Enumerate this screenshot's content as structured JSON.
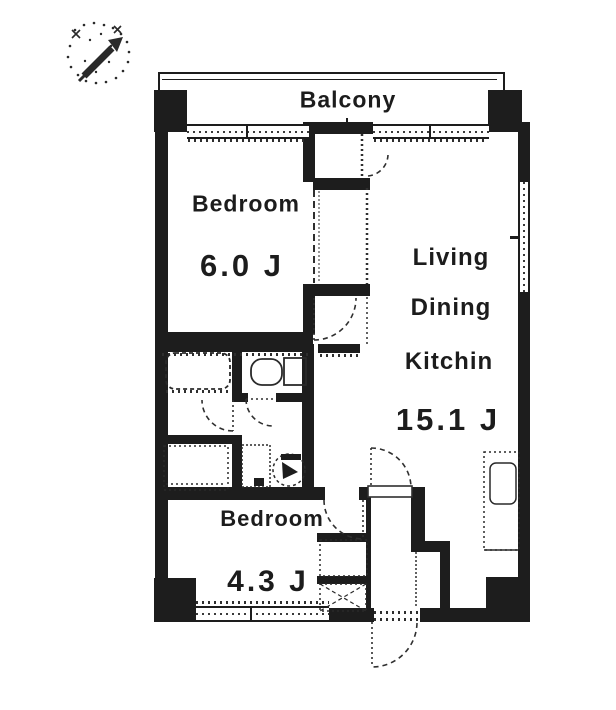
{
  "plan": {
    "balcony": {
      "label": "Balcony"
    },
    "bedroom_main": {
      "label": "Bedroom",
      "area": "6.0 J"
    },
    "living_dining_kitchen": {
      "label_line1": "Living",
      "label_line2": "Dining",
      "label_line3": "Kitchin",
      "area": "15.1 J"
    },
    "bedroom_second": {
      "label": "Bedroom",
      "area": "4.3 J"
    }
  },
  "icons": {
    "compass": "north-arrow-icon",
    "fixtures": [
      "bathtub-icon",
      "toilet-icon",
      "vanity-icon",
      "washing-machine-icon",
      "water-heater-icon",
      "kitchen-sink-icon",
      "storage-cross-icon",
      "door-swing-icon",
      "window-icon"
    ]
  },
  "colors": {
    "ink": "#1d1d1d",
    "paper": "#ffffff"
  }
}
